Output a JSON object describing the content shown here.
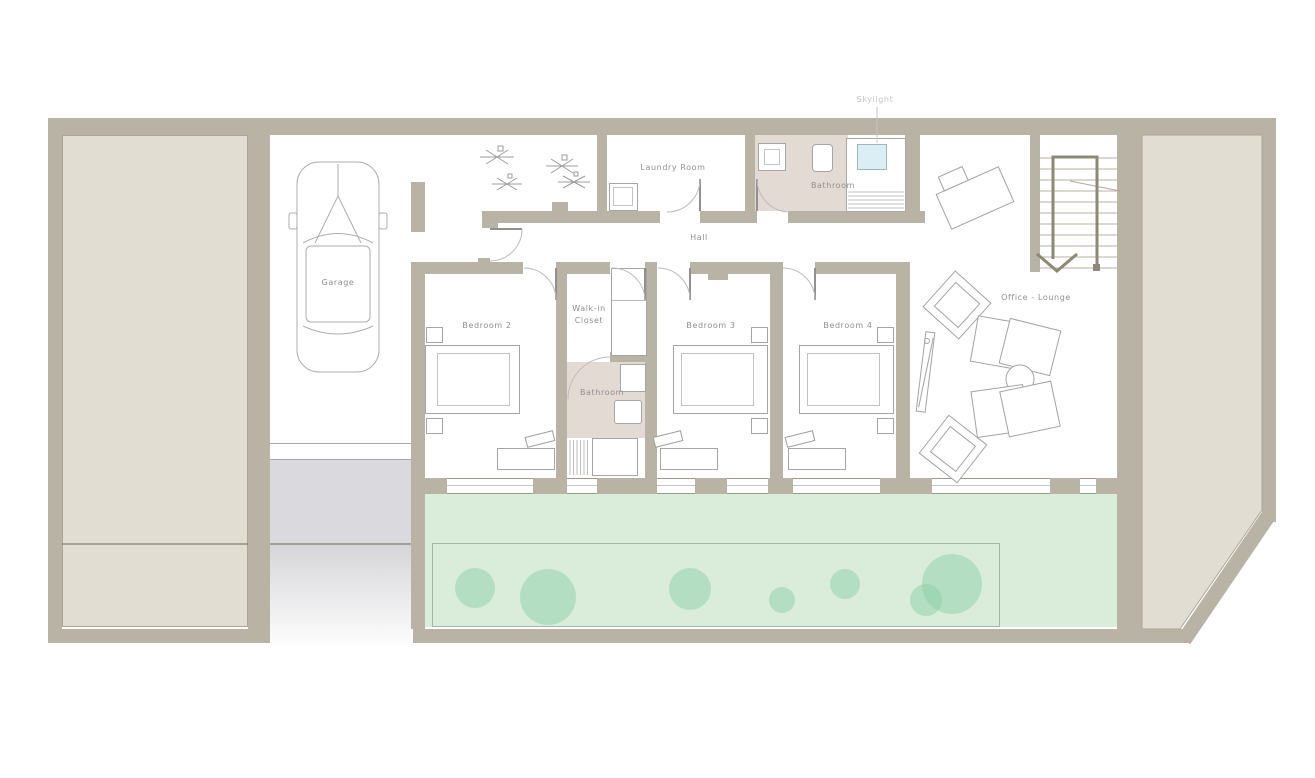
{
  "rooms": {
    "garage": {
      "label": "Garage"
    },
    "laundry_room": {
      "label": "Laundry Room"
    },
    "bathroom_top": {
      "label": "Bathroom"
    },
    "hall": {
      "label": "Hall"
    },
    "bedroom_2": {
      "label": "Bedroom 2"
    },
    "walk_in_closet": {
      "label": "Walk-in Closet"
    },
    "bathroom_middle": {
      "label": "Bathroom"
    },
    "bedroom_3": {
      "label": "Bedroom 3"
    },
    "bedroom_4": {
      "label": "Bedroom 4"
    },
    "office_lounge": {
      "label": "Office - Lounge"
    }
  },
  "annotations": {
    "skylight": {
      "label": "Skylight"
    }
  },
  "colors": {
    "wall": "#b9b3a5",
    "side_panel": "#e1ddd3",
    "bathroom_floor": "#e4dad4",
    "garden": "#d9edda",
    "tree": "#9ed4b2",
    "skylight_glass": "#dceef5",
    "driveway": "#dadade",
    "furniture_line": "#a3a3a3",
    "label_text": "#8f8f8f"
  }
}
